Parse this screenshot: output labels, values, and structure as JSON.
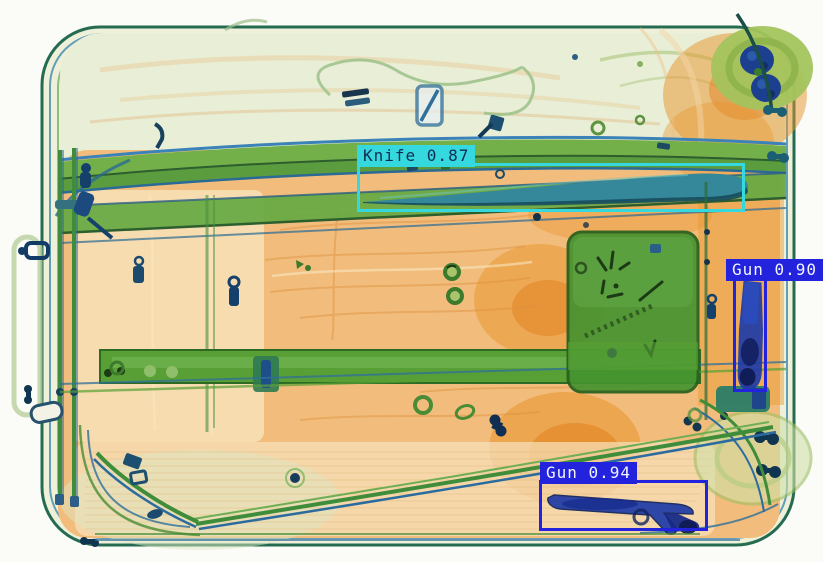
{
  "scene": {
    "description": "X-ray security scan of a suitcase with detected threat objects",
    "palette": {
      "organic_orange": "#eda45a",
      "deep_orange": "#e1861f",
      "pale_shell": "#eef0da",
      "metal_green": "#4f9a38",
      "metal_teal": "#2b7a86",
      "metal_blue": "#1e3aa6",
      "knife_box_cyan": "#35d8de",
      "gun_box_blue": "#2323de"
    }
  },
  "detections": [
    {
      "id": "knife",
      "class_name": "Knife",
      "confidence": "0.87",
      "label": "Knife 0.87",
      "box_color": "#35d8de",
      "text_color": "#0c2d52",
      "box": {
        "x": 357,
        "y": 163,
        "w": 388,
        "h": 49
      },
      "label_dx": -3
    },
    {
      "id": "gun-right",
      "class_name": "Gun",
      "confidence": "0.90",
      "label": "Gun 0.90",
      "box_color": "#2323de",
      "text_color": "#f2f4ff",
      "box": {
        "x": 733,
        "y": 277,
        "w": 34,
        "h": 115
      },
      "label_dx": -10
    },
    {
      "id": "gun-bottom",
      "class_name": "Gun",
      "confidence": "0.94",
      "label": "Gun 0.94",
      "box_color": "#2323de",
      "text_color": "#f2f4ff",
      "box": {
        "x": 539,
        "y": 480,
        "w": 169,
        "h": 51
      },
      "label_dx": -2
    }
  ]
}
